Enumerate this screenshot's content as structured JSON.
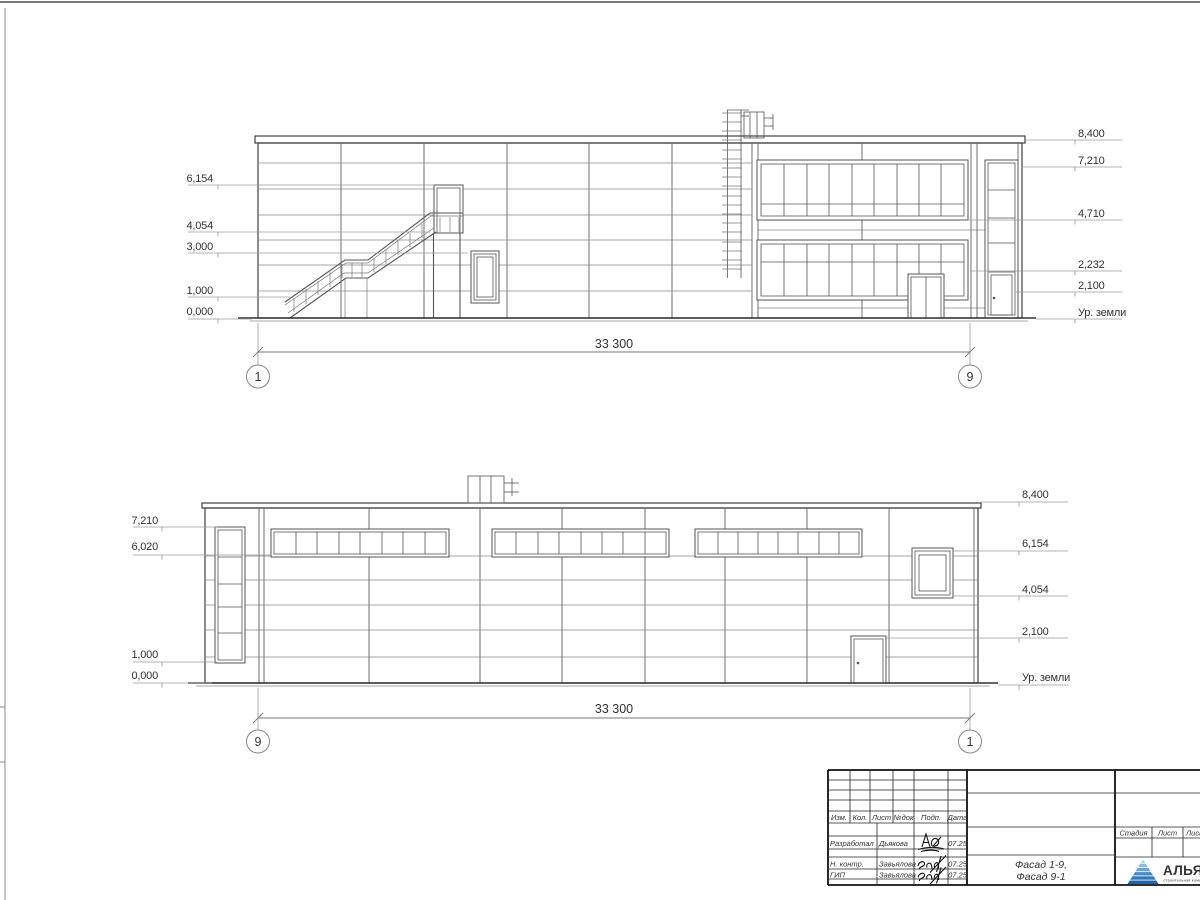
{
  "facade_top": {
    "left_marks": [
      "6,154",
      "4,054",
      "3,000",
      "1,000",
      "0,000"
    ],
    "right_marks": [
      "8,400",
      "7,210",
      "4,710",
      "2,232",
      "2,100"
    ],
    "ground_label": "Ур. земли",
    "dimension": "33 300",
    "axis_left": "1",
    "axis_right": "9"
  },
  "facade_bottom": {
    "left_marks": [
      "7,210",
      "6,020",
      "1,000",
      "0,000"
    ],
    "right_marks": [
      "8,400",
      "6,154",
      "4,054",
      "2,100"
    ],
    "ground_label": "Ур. земли",
    "dimension": "33 300",
    "axis_left": "9",
    "axis_right": "1"
  },
  "title_block": {
    "header_cols": [
      "Изм.",
      "Кол.",
      "Лист",
      "№док",
      "Подп.",
      "Дата"
    ],
    "sign_rows": [
      {
        "role": "Разработал",
        "name": "Дьякова",
        "date": "07.25"
      },
      {
        "role": "Н. контр.",
        "name": "Завьялова",
        "date": "07.25"
      },
      {
        "role": "ГИП",
        "name": "Завьялова",
        "date": "07.25"
      }
    ],
    "doc_title": [
      "Фасад 1-9,",
      "Фасад 9-1"
    ],
    "stage_cols": [
      "Стадия",
      "Лист",
      "Листов"
    ],
    "logo": {
      "text": "АЛЬЯНС",
      "tagline": "строительная компания",
      "text_color": "#1c2f77",
      "tagline_color": "#5b9bd5",
      "stripe_colors": [
        "#aecfe9",
        "#8ab8df",
        "#67a3d4",
        "#4a8cc7",
        "#3279ba",
        "#2064a6"
      ]
    }
  },
  "colors": {
    "drawing_line": "#4a4a4a",
    "seam_line": "#8a8a8a",
    "text": "#2f2f2f"
  }
}
